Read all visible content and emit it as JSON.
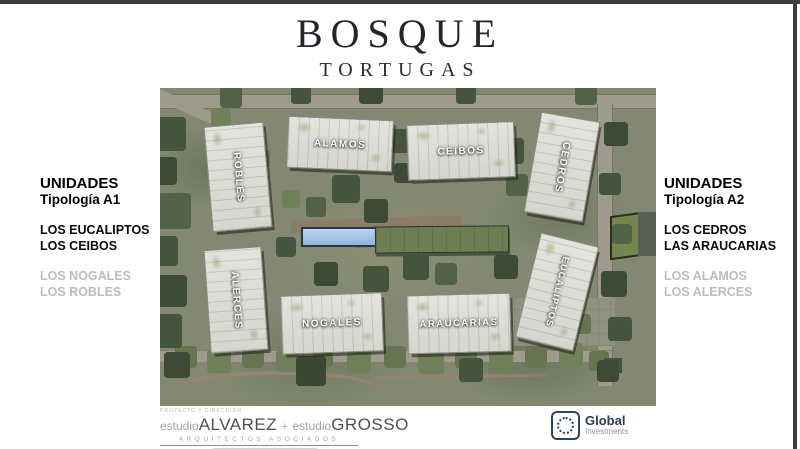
{
  "header": {
    "title": "BOSQUE",
    "subtitle": "TORTUGAS"
  },
  "left_panel": {
    "heading": "UNIDADES",
    "typology": "Tipología A1",
    "featured_units": [
      "LOS EUCALIPTOS",
      "LOS CEIBOS"
    ],
    "other_units": [
      "LOS NOGALES",
      "LOS ROBLES"
    ]
  },
  "right_panel": {
    "heading": "UNIDADES",
    "typology": "Tipología A2",
    "featured_units": [
      "LOS CEDROS",
      "LAS ARAUCARIAS"
    ],
    "other_units": [
      "LOS ALAMOS",
      "LOS ALERCES"
    ]
  },
  "siteplan": {
    "buildings": [
      {
        "name": "ROBLES"
      },
      {
        "name": "ALAMOS"
      },
      {
        "name": "CEIBOS"
      },
      {
        "name": "CEDROS"
      },
      {
        "name": "ALERCES"
      },
      {
        "name": "NOGALES"
      },
      {
        "name": "ARAUCARIAS"
      },
      {
        "name": "EUCALIPTOS"
      }
    ]
  },
  "footer": {
    "credit_label": "PROYECTO Y DIRECCION",
    "studio1_prefix": "estudio",
    "studio1_name": "ALVAREZ",
    "separator": "+",
    "studio2_prefix": "estudio",
    "studio2_name": "GROSSO",
    "tagline": "ARQUITECTOS   ASOCIADOS"
  },
  "brand": {
    "name": "Global",
    "subname": "Investments",
    "color": "#2a4560"
  },
  "colors": {
    "map_base": "#828871",
    "building": "#dddbd4",
    "tree_dark": "#45543c",
    "pool": "#a9c6e6",
    "dim_text": "#bcbcbc",
    "frame": "#3d3d3d"
  }
}
